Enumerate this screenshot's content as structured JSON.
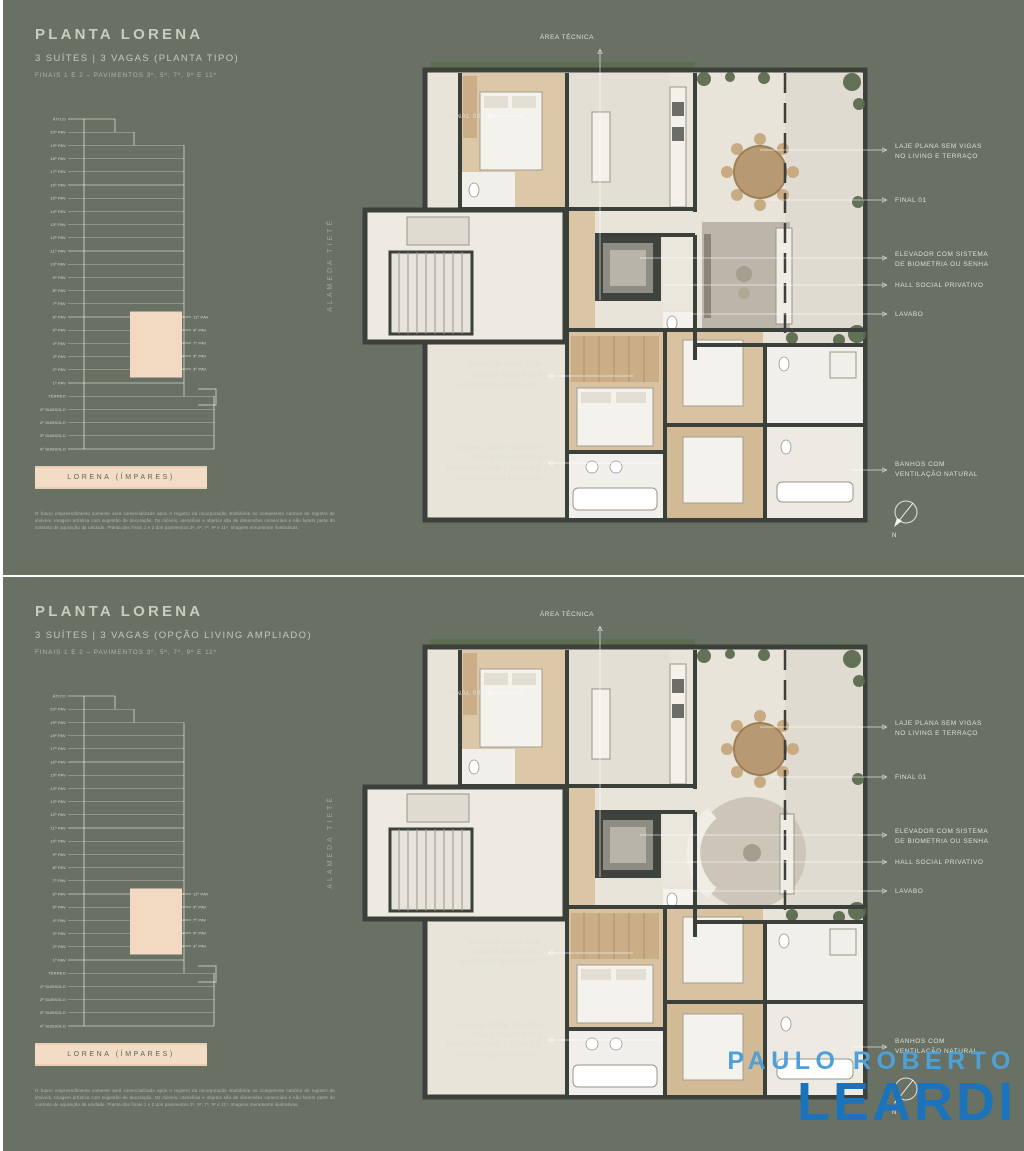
{
  "page": {
    "background_color": "#697064",
    "divider_color": "#ffffff",
    "text_color": "#c9cdbd",
    "banner_bg_color": "#f3dcc5",
    "banner_text_color": "#5a6552"
  },
  "panels": [
    {
      "title": "PLANTA LORENA",
      "subtitle": "3 SUÍTES | 3 VAGAS (PLANTA TIPO)",
      "finais": "FINAIS 1 E 2 – PAVIMENTOS 3º, 5º, 7º, 9º E 11º",
      "banner": "LORENA (ÍMPARES)",
      "street": "ALAMEDA TIETÊ",
      "disclaimer": "O futuro empreendimento somente será comercializado após o registro da incorporação imobiliária no competente cartório de registro de imóveis. Imagem artística com sugestão de decoração. Os móveis, utensílios e objetos são de dimensões comerciais e não fazem parte do contrato de aquisição da unidade. Planta dos finais 1 e 2 dos pavimentos 3º, 5º, 7º, 9º e 11º. Imagens meramente ilustrativas."
    },
    {
      "title": "PLANTA LORENA",
      "subtitle": "3 SUÍTES | 3 VAGAS (OPÇÃO LIVING AMPLIADO)",
      "finais": "FINAIS 1 E 2 – PAVIMENTOS 3º, 5º, 7º, 9º E 11º",
      "banner": "LORENA (ÍMPARES)",
      "street": "ALAMEDA TIETÊ",
      "disclaimer": "O futuro empreendimento somente será comercializado após o registro da incorporação imobiliária no competente cartório de registro de imóveis. Imagem artística com sugestão de decoração. Os móveis, utensílios e objetos são de dimensões comerciais e não fazem parte do contrato de aquisição da unidade. Planta dos finais 1 e 2 dos pavimentos 3º, 5º, 7º, 9º e 11º. Imagens meramente ilustrativas."
    }
  ],
  "annotations": {
    "area_tecnica": "ÁREA TÉCNICA",
    "final02": "FINAL 02",
    "laje": [
      "LAJE PLANA SEM VIGAS",
      "NO LIVING E TERRAÇO"
    ],
    "final01": "FINAL 01",
    "elevador": [
      "ELEVADOR COM SISTEMA",
      "DE BIOMETRIA OU SENHA"
    ],
    "hall": "HALL SOCIAL PRIVATIVO",
    "lavabo": "LAVABO",
    "banhos": [
      "BANHOS COM",
      "VENTILAÇÃO NATURAL"
    ],
    "suite_master": [
      "SUÍTE MASTER COM",
      "AMPLA ÁREA PARA",
      "ARMÁRIOS OU CLOSET"
    ],
    "banho_suite": [
      "BANHO SUÍTE MASTER",
      "COM ESPAÇO PARA",
      "BANCADA COM 2 CUBAS E",
      "VENTILAÇÃO NATURAL"
    ]
  },
  "elevation": {
    "floors": [
      "ÁTICO",
      "20º PAV",
      "19º PAV",
      "18º PAV",
      "17º PAV",
      "16º PAV",
      "15º PAV",
      "14º PAV",
      "13º PAV",
      "12º PAV",
      "11º PAV",
      "10º PAV",
      "9º PAV",
      "8º PAV",
      "7º PAV",
      "6º PAV",
      "5º PAV",
      "4º PAV",
      "3º PAV",
      "2º PAV",
      "1º PAV",
      "TÉRREO",
      "1º SUBSOLO",
      "2º SUBSOLO",
      "3º SUBSOLO",
      "4º SUBSOLO"
    ],
    "highlight_labels": [
      "11º PAV",
      "9º PAV",
      "7º PAV",
      "5º PAV",
      "3º PAV"
    ],
    "highlight_color": "#f2d9c2"
  },
  "compass_label": "N",
  "logo": {
    "line1": "PAULO ROBERTO",
    "line2": "LEARDI",
    "color1": "#4fa0d6",
    "color2": "#1b74bb"
  }
}
